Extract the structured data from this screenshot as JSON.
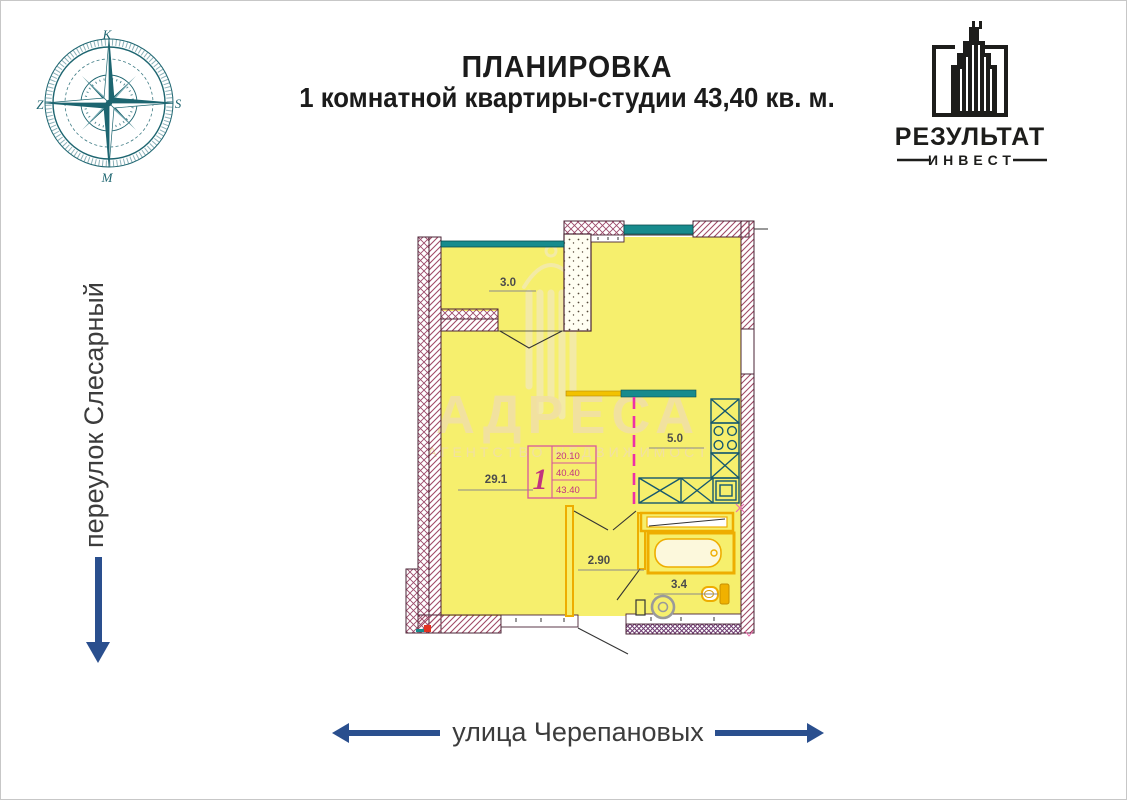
{
  "header": {
    "title_line1": "ПЛАНИРОВКА",
    "title_line2": "1 комнатной квартиры-студии 43,40 кв. м."
  },
  "logo": {
    "brand": "РЕЗУЛЬТАТ",
    "sub": "ИНВЕСТ"
  },
  "compass": {
    "top": "К",
    "right": "S",
    "bottom": "М",
    "left": "Z"
  },
  "streets": {
    "left_label": "переулок Слесарный",
    "bottom_label": "улица Черепановых"
  },
  "watermark": {
    "title": "АДРЕСА",
    "subtitle": "АГЕНТСТВО НЕДВИЖИМОСТИ"
  },
  "plan": {
    "areas": {
      "balcony": "3.0",
      "living": "29.1",
      "kitchen": "5.0",
      "hall": "2.90",
      "bathroom": "3.4"
    },
    "stamp": {
      "rooms_count": "1",
      "row1": "20.10",
      "row2": "40.40",
      "row3": "43.40"
    },
    "colors": {
      "floor": "#f6ef6d",
      "window_teal": "#178b8d",
      "wall_hatch": "#a04a66",
      "bath_fixture": "#eead00",
      "kitchen_fixture": "#15586e",
      "partition_dash": "#ee2fa7",
      "street_arrow": "#2a4f8e",
      "compass": "#1d6570"
    }
  }
}
